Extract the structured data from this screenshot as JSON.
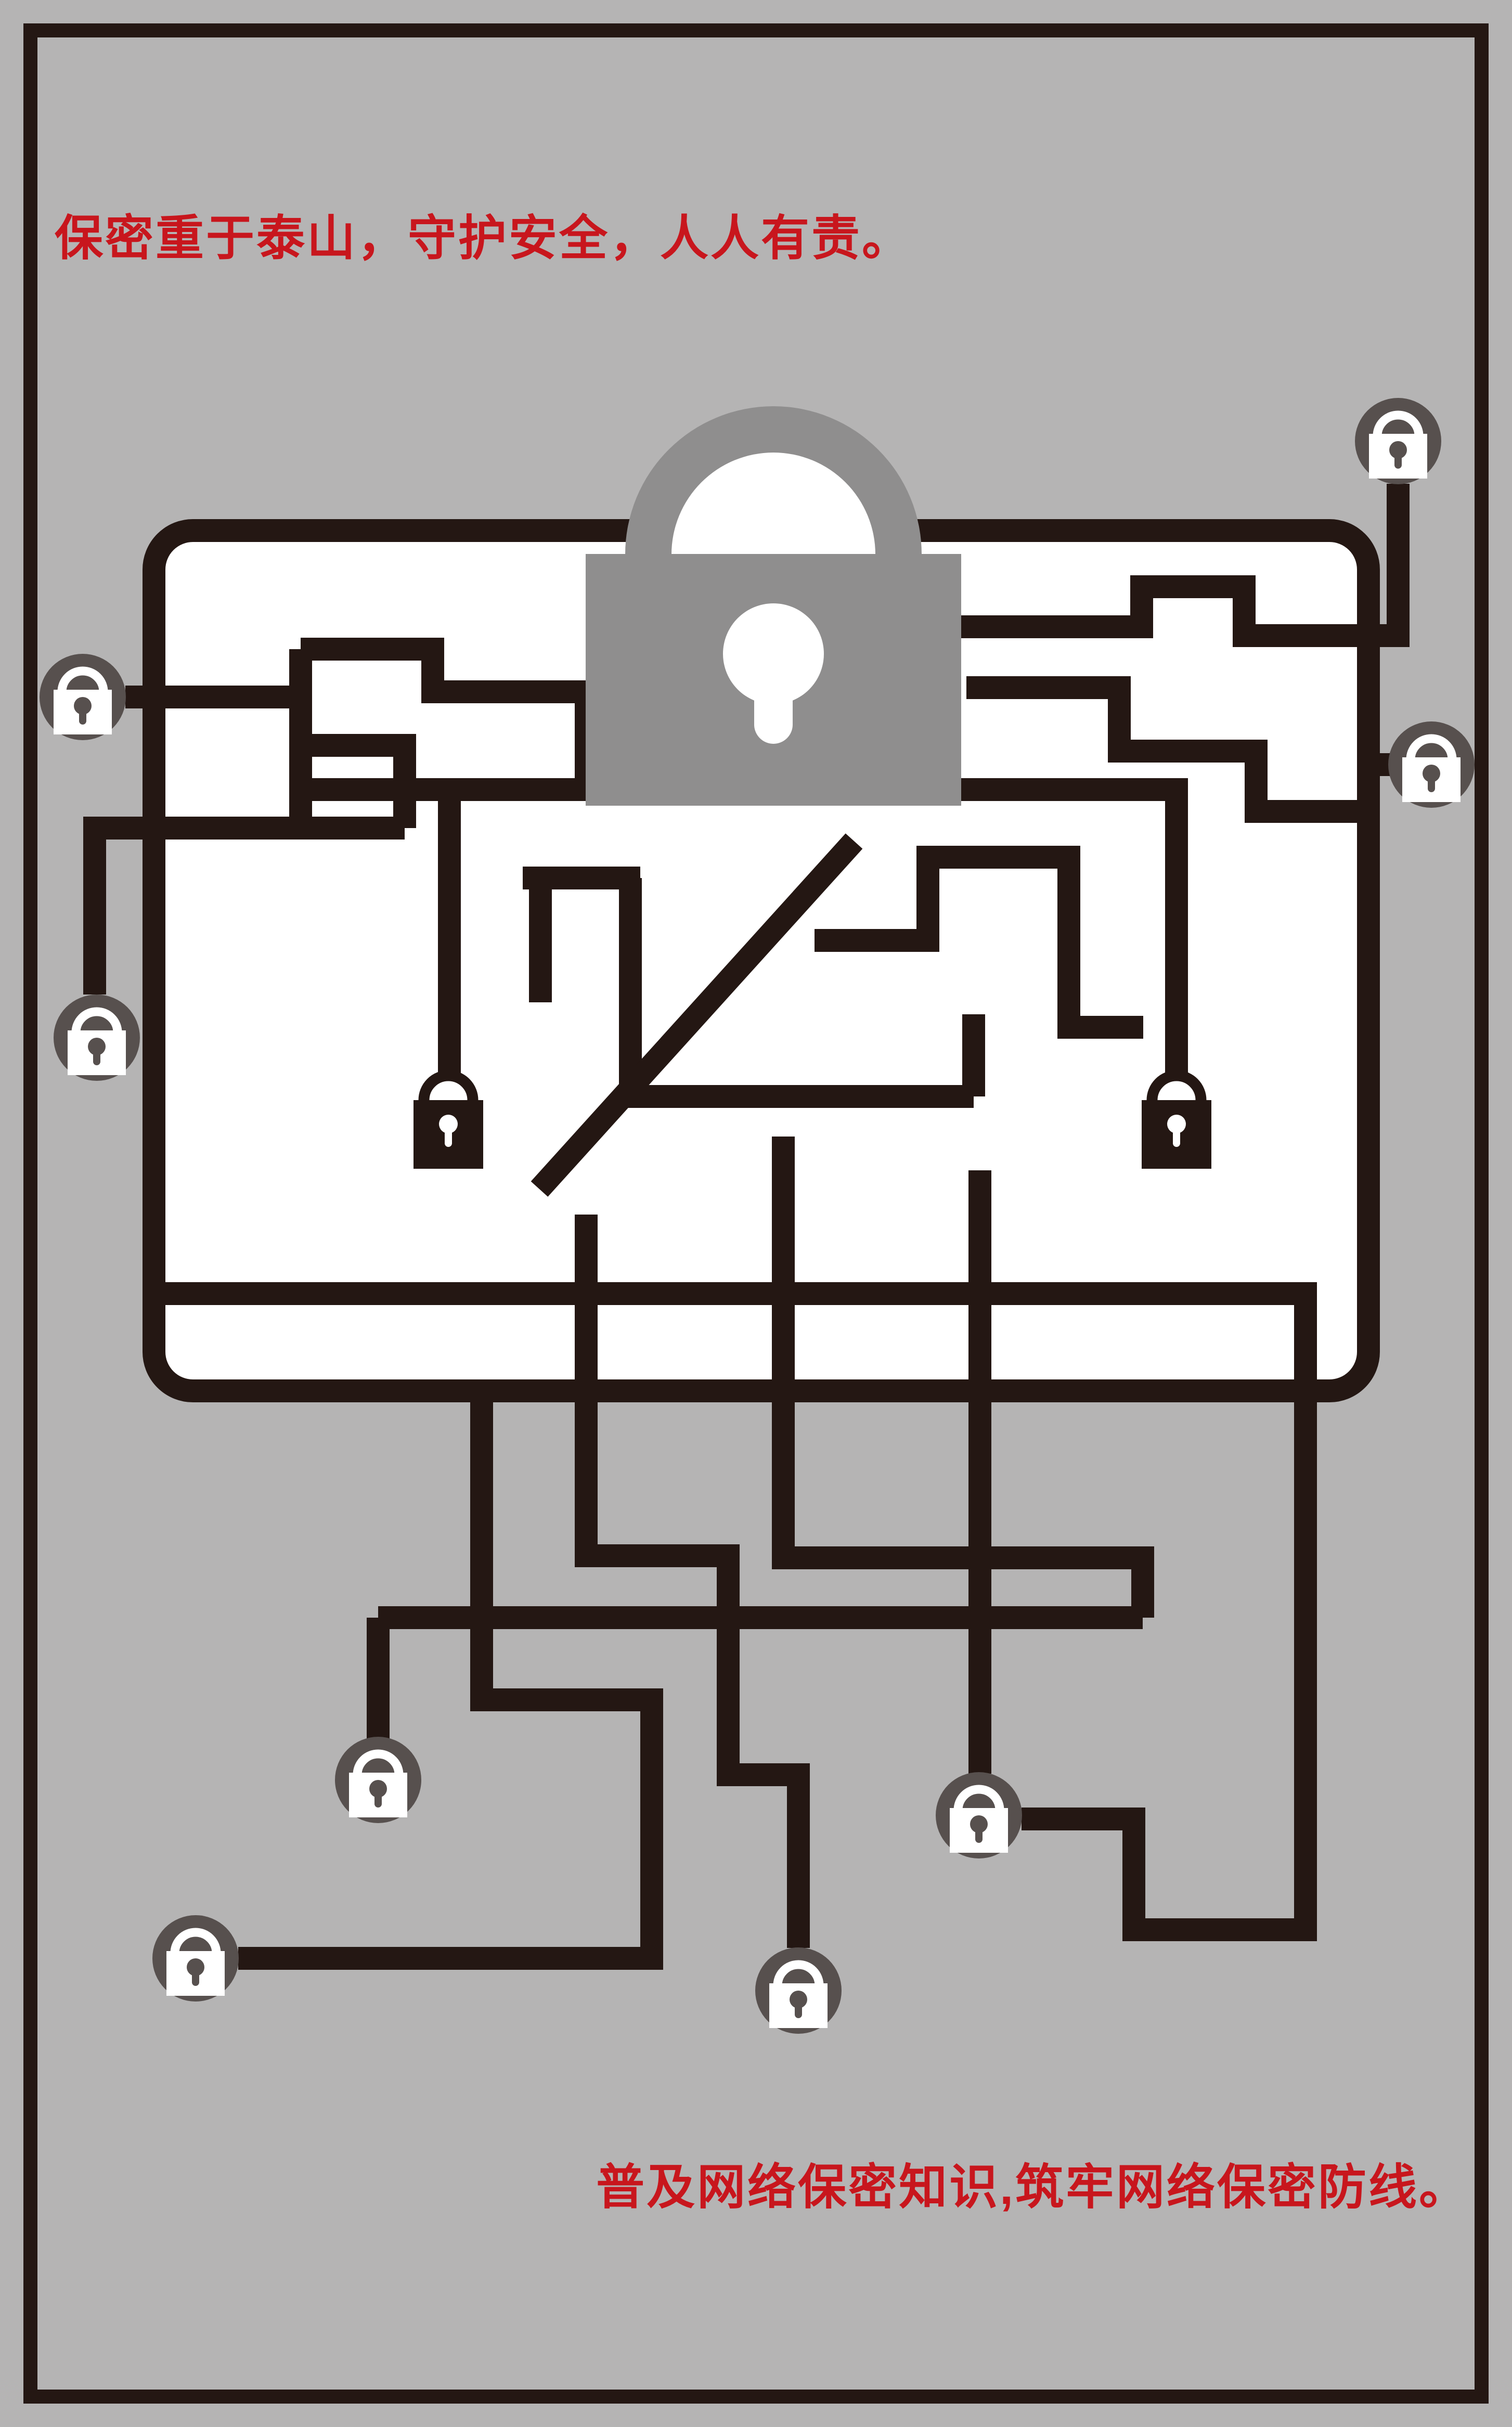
{
  "poster": {
    "top_slogan": "保密重于泰山，守护安全，人人有责。",
    "bottom_slogan": "普及网络保密知识,筑牢网络保密防线。"
  },
  "colors": {
    "background": "#b5b4b4",
    "frame": "#241713",
    "maze_line": "#241713",
    "screen_fill": "#ffffff",
    "big_padlock_gray": "#8f8e8e",
    "badge_lock_circle": "#57504e",
    "slogan_red": "#c8161d"
  },
  "icons": {
    "big_padlock": "big-padlock-icon",
    "badge_padlock": "badge-padlock-icon",
    "badge_padlock_count": 8,
    "silhouette_padlock": "silhouette-padlock-icon",
    "silhouette_padlock_count": 2
  }
}
